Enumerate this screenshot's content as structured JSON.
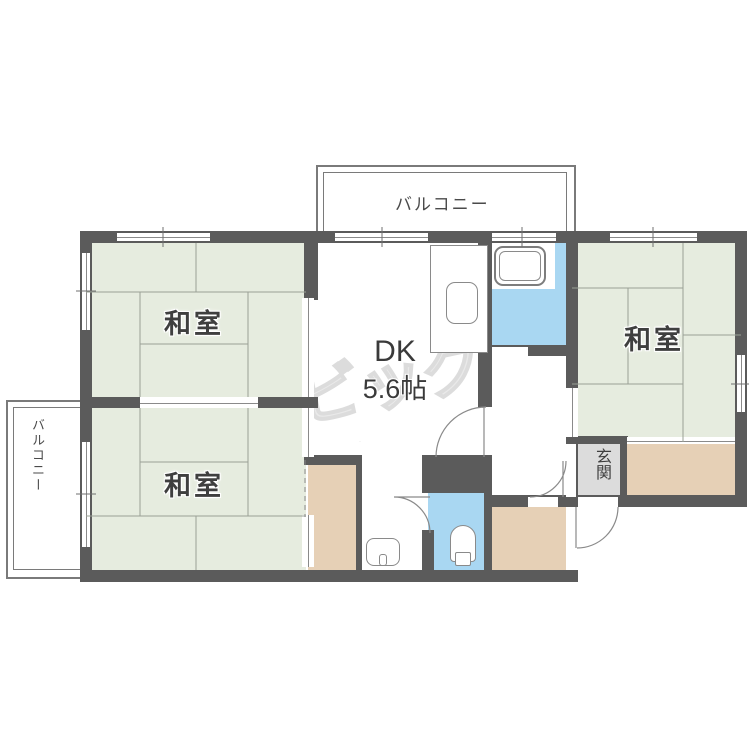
{
  "plan": {
    "rooms": {
      "balcony_top": {
        "label": "バルコニー"
      },
      "balcony_left": {
        "label": "バルコニー"
      },
      "washitsu_nw": {
        "label": "和室"
      },
      "washitsu_sw": {
        "label": "和室"
      },
      "washitsu_e": {
        "label": "和室"
      },
      "dk": {
        "name": "DK",
        "size": "5.6帖"
      },
      "genkan": {
        "label": "玄関"
      }
    },
    "fixtures": {
      "bathtub": "bathtub-icon",
      "kitchen_sink": "kitchen-sink-icon",
      "toilet": "toilet-icon",
      "washing_machine_pan": "washer-pan-icon"
    },
    "watermark": {
      "text": "ビッグ"
    },
    "colors": {
      "wall": "#5b5b5b",
      "tatami": "#e6ecdf",
      "water_area": "#a9d7f2",
      "closet": "#e6d0b6",
      "genkan": "#dcdcdc",
      "tatami_line": "#9aa096",
      "text": "#3f3f3f",
      "watermark": "#e4e4e4"
    }
  }
}
